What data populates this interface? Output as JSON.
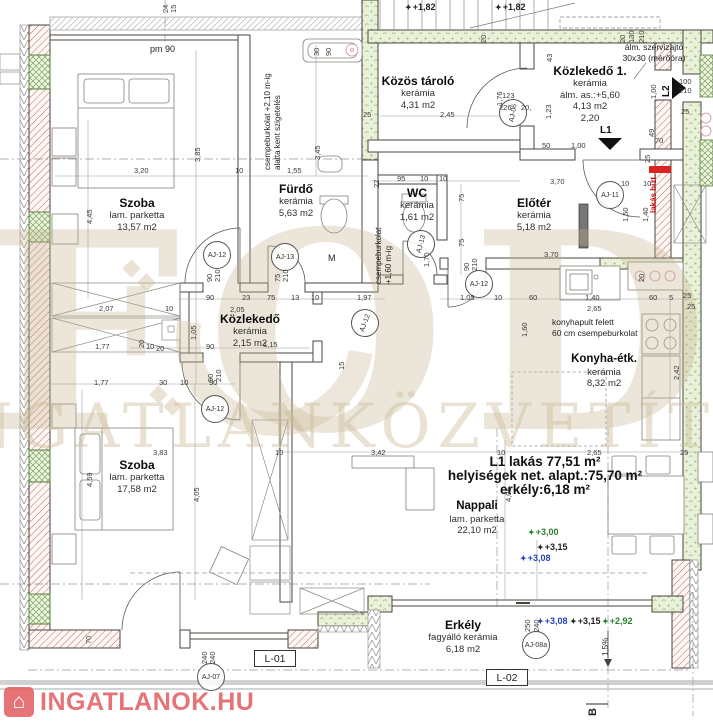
{
  "title": "L1 lakás alaprajz",
  "summary": {
    "line1": "L1 lakás 77,51 m²",
    "line2": "helyiségek net. alapt.:75,70 m²",
    "line3": "erkély:6,18 m²"
  },
  "rooms": {
    "szoba1": {
      "name": "Szoba",
      "finish": "lam. parketta",
      "area": "13,57 m2"
    },
    "furdo": {
      "name": "Fürdő",
      "finish": "kerámia",
      "area": "5,63 m2"
    },
    "tarolo": {
      "name": "Közös tároló",
      "finish": "kerámia",
      "area": "4,31 m2"
    },
    "kozlekedo1": {
      "name": "Közlekedő 1.",
      "finish": "kerámia",
      "note": "álm. as.:+5,60",
      "area": "4,13 m2",
      "dim_note": "2,20"
    },
    "wc": {
      "name": "WC",
      "finish": "kerámia",
      "area": "1,61 m2"
    },
    "eloter": {
      "name": "Előtér",
      "finish": "kerámia",
      "area": "5,18 m2"
    },
    "kozlekedo": {
      "name": "Közlekedő",
      "finish": "kerámia",
      "area": "2,15 m2"
    },
    "konyha": {
      "name": "Konyha-étk.",
      "finish": "kerámia",
      "area": "8,32 m2"
    },
    "szoba2": {
      "name": "Szoba",
      "finish": "lam. parketta",
      "area": "17,58 m2"
    },
    "nappali": {
      "name": "Nappali",
      "finish": "lam. parketta",
      "area": "22,10 m2"
    },
    "erkely": {
      "name": "Erkély",
      "finish": "fagyálló kerámia",
      "area": "6,18 m2"
    }
  },
  "notes": {
    "szerviz1": "álm. szervizajtó",
    "szerviz2": "30x30 (mérőóra)",
    "csempe1a": "csempeburkolat +2,10 m-ig",
    "csempe1b": "alatta kent szigetelés",
    "csempe2a": "csempeburkolat",
    "csempe2b": "+1,60 m-ig",
    "konyhapult1": "konyhapult felett",
    "konyhapult2": "60 cm csempeburkolat",
    "lakas_bizt": "lakás bizt.",
    "m_label": "M",
    "pm": "pm 90",
    "slope": "1,5%",
    "section_b": "B"
  },
  "openings": {
    "l1": "L1",
    "l2": "L2",
    "l01": "L-01",
    "l02": "L-02"
  },
  "door_tags": [
    "AJ-12",
    "AJ-13",
    "AJ-12",
    "AJ-12",
    "AJ-12",
    "AJ-13",
    "AJ-06",
    "AJ-11",
    "AJ-07",
    "AJ-08a"
  ],
  "levels": [
    {
      "value": "+1,82",
      "color": "#222222"
    },
    {
      "value": "+1,82",
      "color": "#222222"
    },
    {
      "value": "+3,00",
      "color": "#2e7d32"
    },
    {
      "value": "+3,15",
      "color": "#222222"
    },
    {
      "value": "+3,08",
      "color": "#2343b8"
    },
    {
      "value": "+3,08",
      "color": "#2343b8"
    },
    {
      "value": "+3,15",
      "color": "#222222"
    },
    {
      "value": "+2,92",
      "color": "#2e7d32"
    }
  ],
  "dims": [
    "3,20",
    "3,85",
    "4,45",
    "10",
    "1,55",
    "30",
    "90",
    "3,45",
    "25",
    "2,45",
    "1,76",
    "123",
    "226",
    "20,",
    "1,23",
    "43",
    "20",
    "20",
    "130",
    "210",
    "1,00",
    "100",
    "210",
    "25",
    "49",
    "70",
    "25",
    "50",
    "1,00",
    "3,70",
    "10",
    "10",
    "1,50",
    "1,40",
    "22",
    "95",
    "10",
    "10",
    "75",
    "75",
    "1,70",
    "90",
    "210",
    "3,70",
    "1,05",
    "10",
    "60",
    "1,40",
    "2,65",
    "60",
    "5",
    "25",
    "25",
    "1,60",
    "2,42",
    "20",
    "2,07",
    "10",
    "1,77",
    "20",
    "10",
    "20",
    "90",
    "23",
    "75",
    "13",
    "10",
    "2,05",
    "1,05",
    "1,97",
    "90",
    "1,15",
    "15",
    "90",
    "210",
    "75",
    "210",
    "90",
    "210",
    "1,77",
    "30",
    "10",
    "90",
    "3,83",
    "4,59",
    "4,05",
    "4,05",
    "10",
    "3,42",
    "10",
    "2,65",
    "25",
    "70",
    "250",
    "240",
    "240",
    "240",
    "24",
    "15"
  ],
  "watermark": {
    "brand": "FODOR",
    "tagline": "INGATLANKÖZVETÍTŐ KFT"
  },
  "logo": {
    "text": "INGATLANOK.HU",
    "icon": "house-icon"
  },
  "colors": {
    "wall_hatch_red": "#c0685a",
    "insulation_green": "#9cba78",
    "accent_red": "#dd2222",
    "level_green": "#2e7d32",
    "level_blue": "#2343b8",
    "watermark_beige": "#cbb996",
    "logo_red": "#e25a5e"
  }
}
